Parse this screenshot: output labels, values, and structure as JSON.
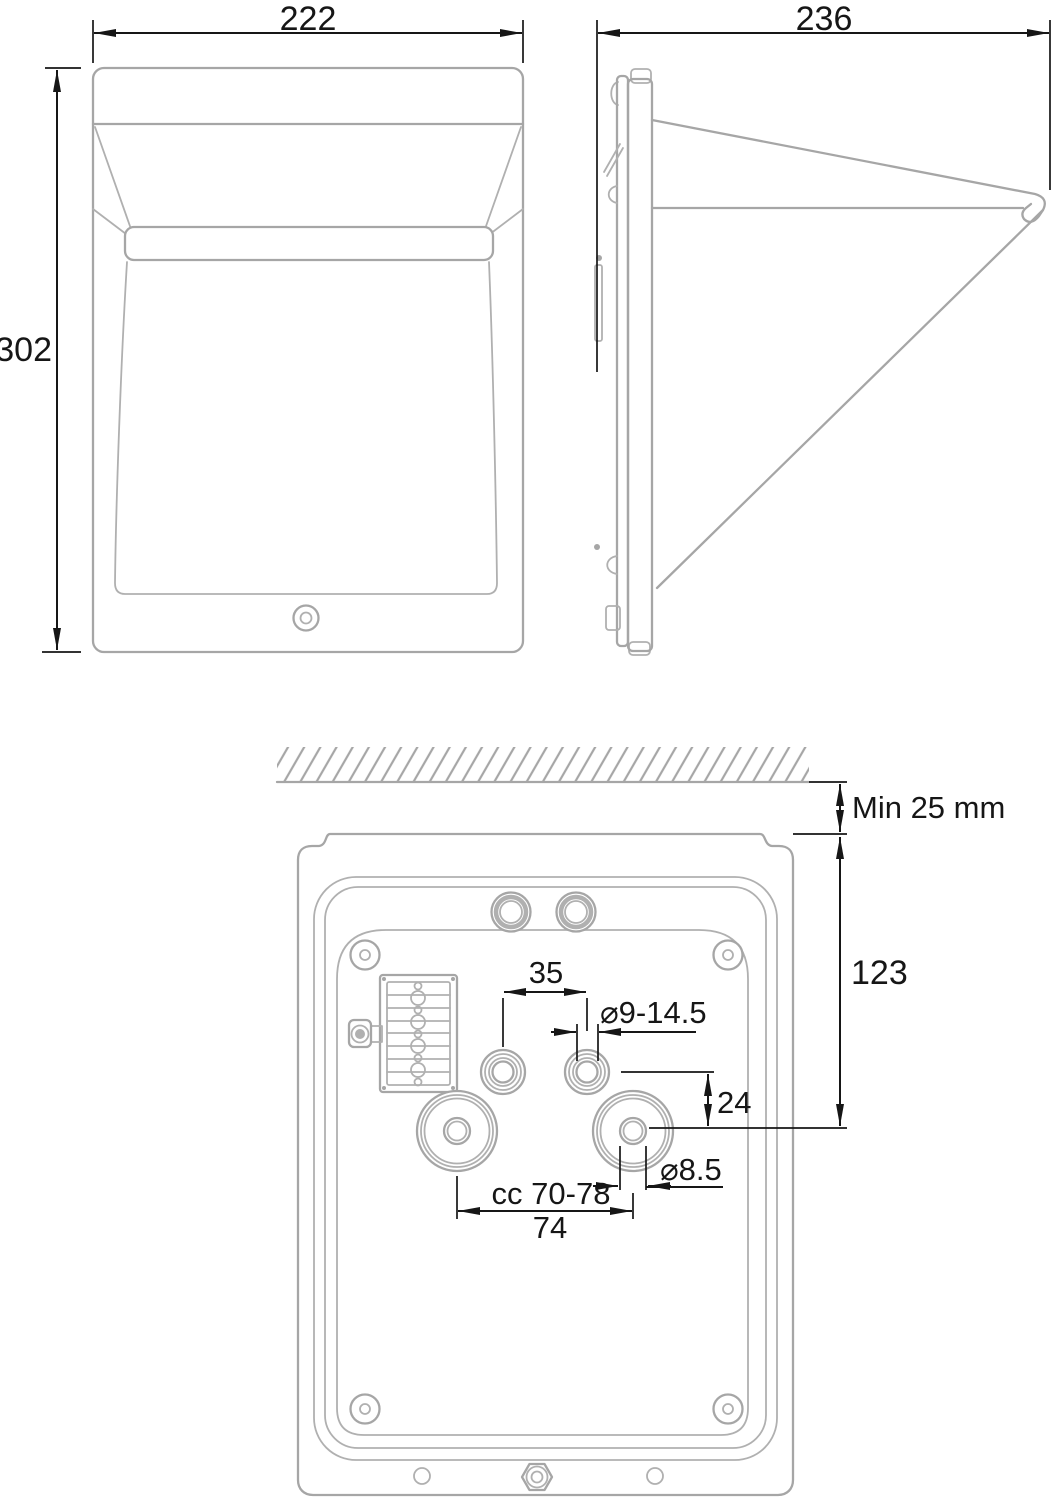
{
  "front_view": {
    "width_label": "222",
    "height_label": "302"
  },
  "side_view": {
    "depth_label": "236"
  },
  "back_view": {
    "clearance_label": "Min 25 mm",
    "top_to_keyhole_label": "123",
    "hole_spacing_label": "35",
    "hole_diameter_label": "⌀9-14.5",
    "keyhole_offset_label": "24",
    "keyhole_hole_diameter_label": "⌀8.5",
    "center_distance_label": "cc 70-78",
    "center_distance_nominal_label": "74"
  },
  "colors": {
    "drawing_line": "#a6a6a6",
    "dimension_line": "#161616",
    "background": "#ffffff"
  }
}
